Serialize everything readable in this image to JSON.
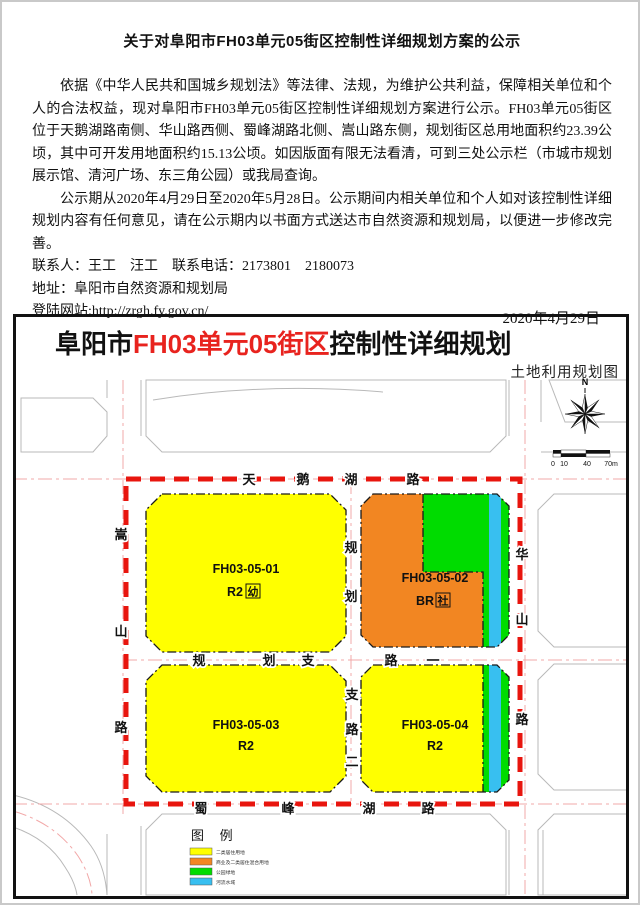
{
  "notice": {
    "title": "关于对阜阳市FH03单元05街区控制性详细规划方案的公示",
    "para1": "依据《中华人民共和国城乡规划法》等法律、法规，为维护公共利益，保障相关单位和个人的合法权益，现对阜阳市FH03单元05街区控制性详细规划方案进行公示。FH03单元05街区位于天鹅湖路南侧、华山路西侧、蜀峰湖路北侧、嵩山路东侧，规划街区总用地面积约23.39公顷，其中可开发用地面积约15.13公顷。如因版面有限无法看清，可到三处公示栏（市城市规划展示馆、清河广场、东三角公园）或我局查询。",
    "para2": "公示期从2020年4月29日至2020年5月28日。公示期间内相关单位和个人如对该控制性详细规划内容有任何意见，请在公示期内以书面方式送达市自然资源和规划局，以便进一步修改完善。",
    "contact_line": "联系人：王工　汪工　联系电话：2173801　2180073",
    "address_line": "地址：阜阳市自然资源和规划局",
    "website_line": "登陆网站:http://zrgh.fy.gov.cn/",
    "date": "2020年4月29日"
  },
  "map": {
    "title_city": "阜阳市",
    "title_unit": "FH03单元05街区",
    "title_tail": "控制性详细规划",
    "subtitle": "土地利用规划图",
    "compass": {
      "north_label": "N"
    },
    "scale_bar": {
      "tick0": "0",
      "tick1": "10",
      "tick2": "40",
      "tick3": "70m"
    },
    "roads": {
      "tianehu": "天鹅湖路",
      "guihua_zhilu_yi": "规划支路一",
      "shufenghu": "蜀峰湖路",
      "songshan": "嵩山路",
      "huashan": "华山路",
      "zhilu_er_top": "规划",
      "zhilu_er_bottom": "支路二"
    },
    "parcels": [
      {
        "id": "FH03-05-01",
        "use_code": "R2",
        "facility_tag": "幼",
        "fill": "#ffff00"
      },
      {
        "id": "FH03-05-02",
        "use_code": "BR",
        "facility_tag": "社",
        "fill": "#f28622"
      },
      {
        "id": "FH03-05-03",
        "use_code": "R2",
        "fill": "#ffff00"
      },
      {
        "id": "FH03-05-04",
        "use_code": "R2",
        "fill": "#ffff00"
      }
    ],
    "legend": {
      "title": "图 例",
      "items": [
        {
          "label": "二类居住用地",
          "color": "#ffff00"
        },
        {
          "label": "商业及二类居住混合用地",
          "color": "#f28622"
        },
        {
          "label": "公园绿地",
          "color": "#00dc00"
        },
        {
          "label": "河流水域",
          "color": "#38bff0"
        }
      ]
    }
  },
  "colors": {
    "boundary_red": "#e8150e",
    "title_red": "#e8231e",
    "residential_yellow": "#ffff00",
    "mixed_orange": "#f28622",
    "green": "#00dc00",
    "water_cyan": "#38bff0",
    "road_centerline_pink": "#f2a8a8",
    "road_edge_gray": "#b9b9b9"
  }
}
